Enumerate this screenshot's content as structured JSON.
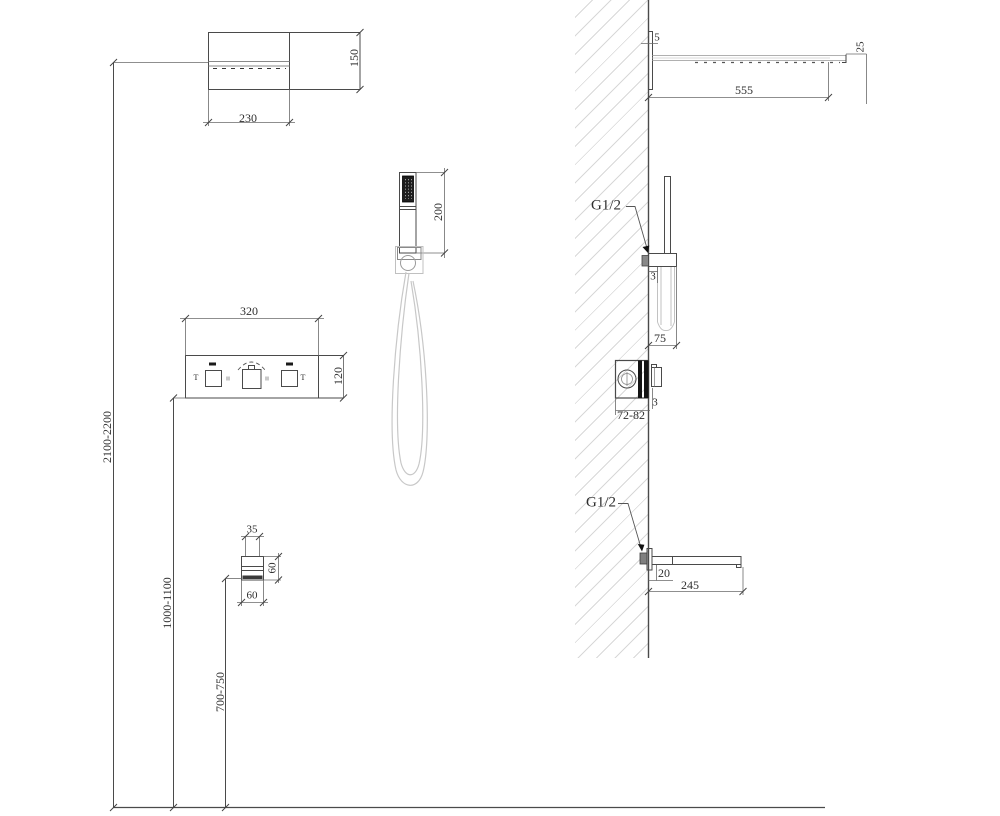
{
  "labels": {
    "head_width": "230",
    "head_depth": "150",
    "hand_shower_length": "200",
    "panel_width": "320",
    "panel_height": "120",
    "spout_width": "35",
    "spout_height": "60",
    "spout_depth": "60",
    "height_head": "2100-2200",
    "height_panel": "1000-1100",
    "height_spout": "700-750",
    "head_plate_offset": "5",
    "head_arm_length": "555",
    "head_edge_height": "25",
    "hand_connection": "G1/2",
    "hand_gap": "3",
    "hand_holder_depth": "75",
    "valve_plate_gap": "3",
    "valve_depth": "72-82",
    "spout_connection": "G1/2",
    "spout_drop": "20",
    "spout_length": "245",
    "knob_left_mark": "T",
    "knob_right_mark": "T"
  },
  "colors": {
    "line": "#4a4a4a",
    "dim_line": "#6a6a6a",
    "light_line": "#c6c6c6",
    "hatch": "#d8d8d8",
    "dark_fill": "#161616"
  }
}
